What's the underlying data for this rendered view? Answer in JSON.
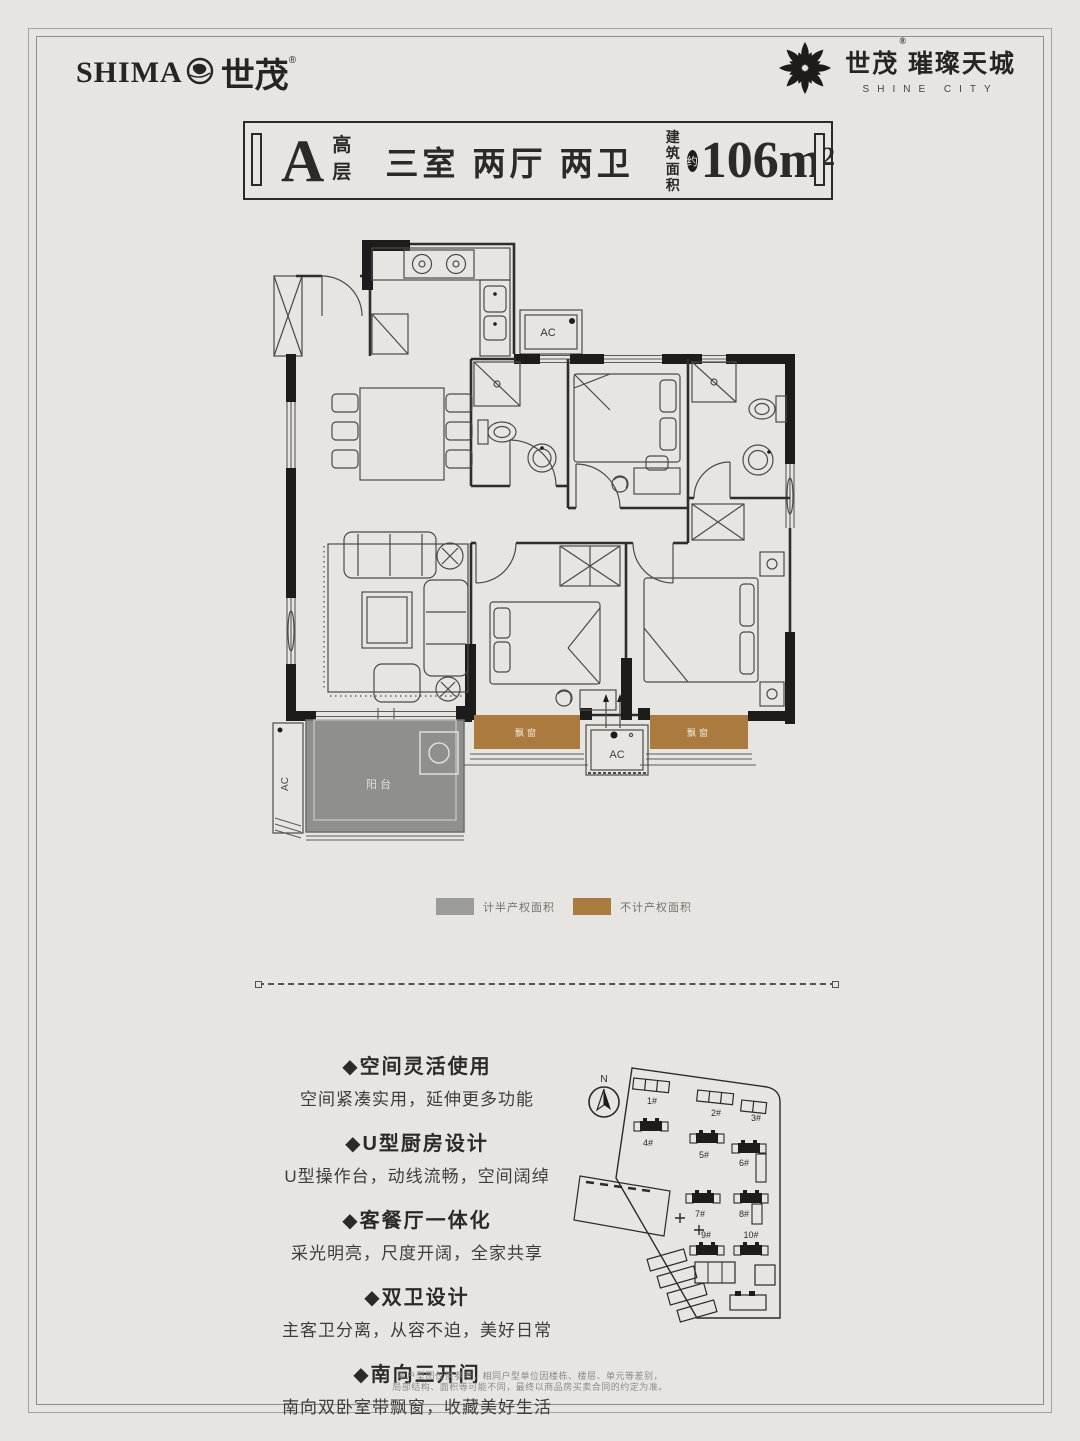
{
  "header": {
    "left_logo": {
      "latin": "SHIMA",
      "cjk": "世茂",
      "reg": "®"
    },
    "right_logo": {
      "cjk": "世茂",
      "reg": "®",
      "sub": "璀璨天城",
      "en": "SHINE CITY"
    }
  },
  "titlebar": {
    "unit": "A",
    "grade": "高层",
    "rooms": "三室 两厅 两卫",
    "area_label_line1": "建筑",
    "area_label_line2": "面积",
    "approx": "约",
    "value": "106m",
    "sup": "2"
  },
  "floorplan": {
    "labels": {
      "balcony": "阳台",
      "bay_left": "飘窗",
      "bay_right": "飘窗",
      "ac_top": "AC",
      "ac_mid": "AC",
      "ac_left": "AC"
    },
    "colors": {
      "balcony": "#8f8f8d",
      "bay_window": "#ab7a3e",
      "wall": "#1d1c1a"
    }
  },
  "legend": {
    "items": [
      {
        "label": "计半产权面积",
        "color": "#9b9b99"
      },
      {
        "label": "不计产权面积",
        "color": "#ab7a3e"
      }
    ]
  },
  "features": [
    {
      "title": "◆空间灵活使用",
      "desc": "空间紧凑实用，延伸更多功能"
    },
    {
      "title": "◆U型厨房设计",
      "desc": "U型操作台，动线流畅，空间阔绰"
    },
    {
      "title": "◆客餐厅一体化",
      "desc": "采光明亮，尺度开阔，全家共享"
    },
    {
      "title": "◆双卫设计",
      "desc": "主客卫分离，从容不迫，美好日常"
    },
    {
      "title": "◆南向三开间",
      "desc": "南向双卧室带飘窗，收藏美好生活"
    }
  ],
  "sitemap": {
    "north_label": "N",
    "buildings": [
      {
        "id": "1#",
        "highlighted": false
      },
      {
        "id": "2#",
        "highlighted": false
      },
      {
        "id": "3#",
        "highlighted": false
      },
      {
        "id": "4#",
        "highlighted": true
      },
      {
        "id": "5#",
        "highlighted": true
      },
      {
        "id": "6#",
        "highlighted": true
      },
      {
        "id": "7#",
        "highlighted": true
      },
      {
        "id": "8#",
        "highlighted": true
      },
      {
        "id": "9#",
        "highlighted": true
      },
      {
        "id": "10#",
        "highlighted": true
      }
    ]
  },
  "disclaimer": {
    "line1": "本户型图仅供参考，相同户型单位因楼栋、楼层、单元等差别，",
    "line2": "局部结构、面积等可能不同，最终以商品房买卖合同的约定为准。"
  }
}
